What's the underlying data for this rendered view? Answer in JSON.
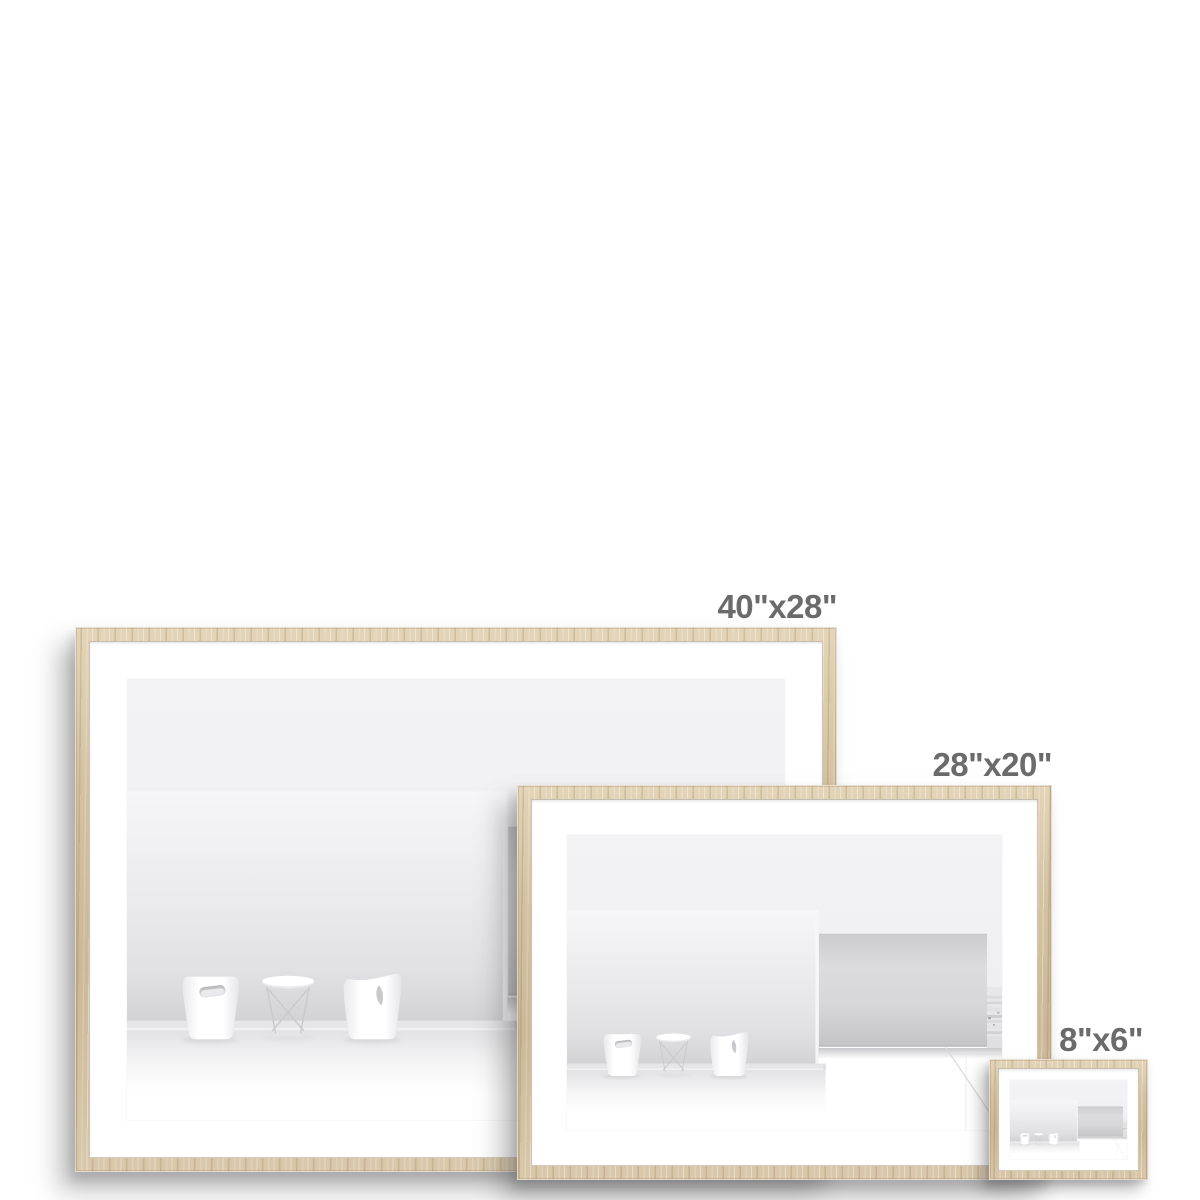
{
  "page": {
    "background": "#ffffff"
  },
  "product": {
    "name": "framed-print-size-comparison",
    "sizes": [
      {
        "label": "40\"x28\""
      },
      {
        "label": "28\"x20\""
      },
      {
        "label": "8\"x6\""
      }
    ]
  },
  "colors": {
    "background": "#ffffff",
    "frame_wood": "#d4c2a3",
    "frame_wood_grain_dark": "#b9a684",
    "frame_wood_highlight": "#e7d9bf",
    "mat": "#ffffff",
    "label_text": "#6b6b6b",
    "artwork_wall_light": "#f2f2f4",
    "artwork_wall_shadow": "#d5d5d7",
    "artwork_block_gray": "#cfcfd1",
    "artwork_floor": "#ffffff"
  }
}
